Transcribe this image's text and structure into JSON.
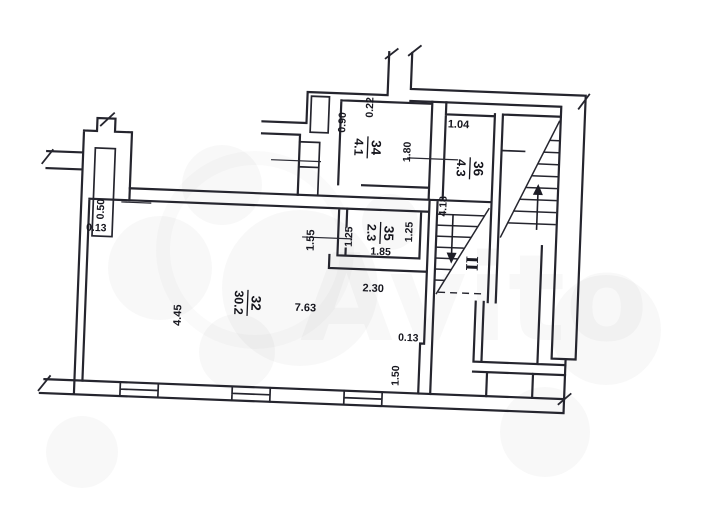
{
  "document": {
    "type": "apartment floor plan (scanned)"
  },
  "rooms": {
    "r32": {
      "number": "32",
      "area": "30.2"
    },
    "r34": {
      "number": "34",
      "area": "4.1"
    },
    "r35": {
      "number": "35",
      "area": "2.3"
    },
    "r36": {
      "number": "36",
      "area": "4.3"
    }
  },
  "dimensions": {
    "left_chimney_offset": "0.50",
    "left_wall_step": "0.13",
    "room32_width": "4.45",
    "room32_length": "7.63",
    "room32_top_right": "2.30",
    "corridor_left": "1.55",
    "room35_left": "1.25",
    "room35_right": "1.25",
    "room35_bottom": "1.85",
    "room34_niche": "0.90",
    "room34_top": "0.22",
    "room34_door": "1.80",
    "room36_top": "1.04",
    "stair_run": "4.18",
    "right_wall_step": "0.13",
    "right_wall_bottom": "1.50"
  },
  "stairs": {
    "flight_label": "II"
  },
  "watermark": {
    "brand": "Avito"
  }
}
